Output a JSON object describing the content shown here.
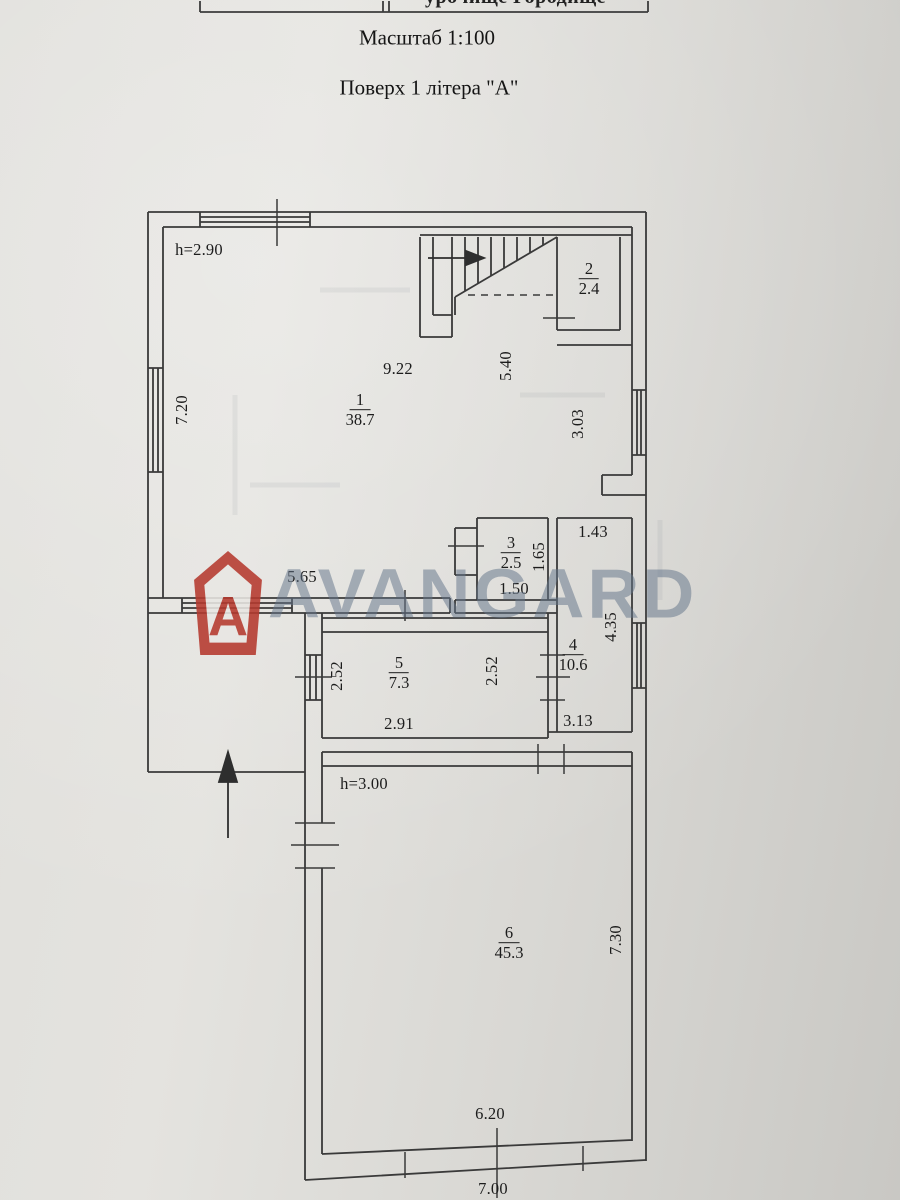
{
  "document": {
    "location_header": "урочище Городище",
    "scale_line": "Масштаб 1:100",
    "floor_line": "Поверх 1 літера \"А\""
  },
  "watermark": {
    "text": "AVANGARD",
    "icon_letter": "A",
    "accent_color": "#b5392e",
    "text_color": "#63748b"
  },
  "rooms": {
    "r1": {
      "num": "1",
      "area": "38.7"
    },
    "r2": {
      "num": "2",
      "area": "2.4"
    },
    "r3": {
      "num": "3",
      "area": "2.5"
    },
    "r4": {
      "num": "4",
      "area": "10.6"
    },
    "r5": {
      "num": "5",
      "area": "7.3"
    },
    "r6": {
      "num": "6",
      "area": "45.3"
    }
  },
  "heights": {
    "room1": "h=2.90",
    "room6": "h=3.00"
  },
  "dims": {
    "room1_top_width": "9.22",
    "room1_stair_side": "5.40",
    "left_wall": "7.20",
    "right_mid": "3.03",
    "room1_bottom": "5.65",
    "room3_height": "1.65",
    "room3_width": "1.50",
    "room4_top": "1.43",
    "room4_right": "4.35",
    "room5_left": "2.52",
    "room5_right": "2.52",
    "room5_width": "2.91",
    "room4_bottom": "3.13",
    "room6_right": "7.30",
    "room6_bottom_inner": "6.20",
    "room6_bottom_outer": "7.00"
  }
}
